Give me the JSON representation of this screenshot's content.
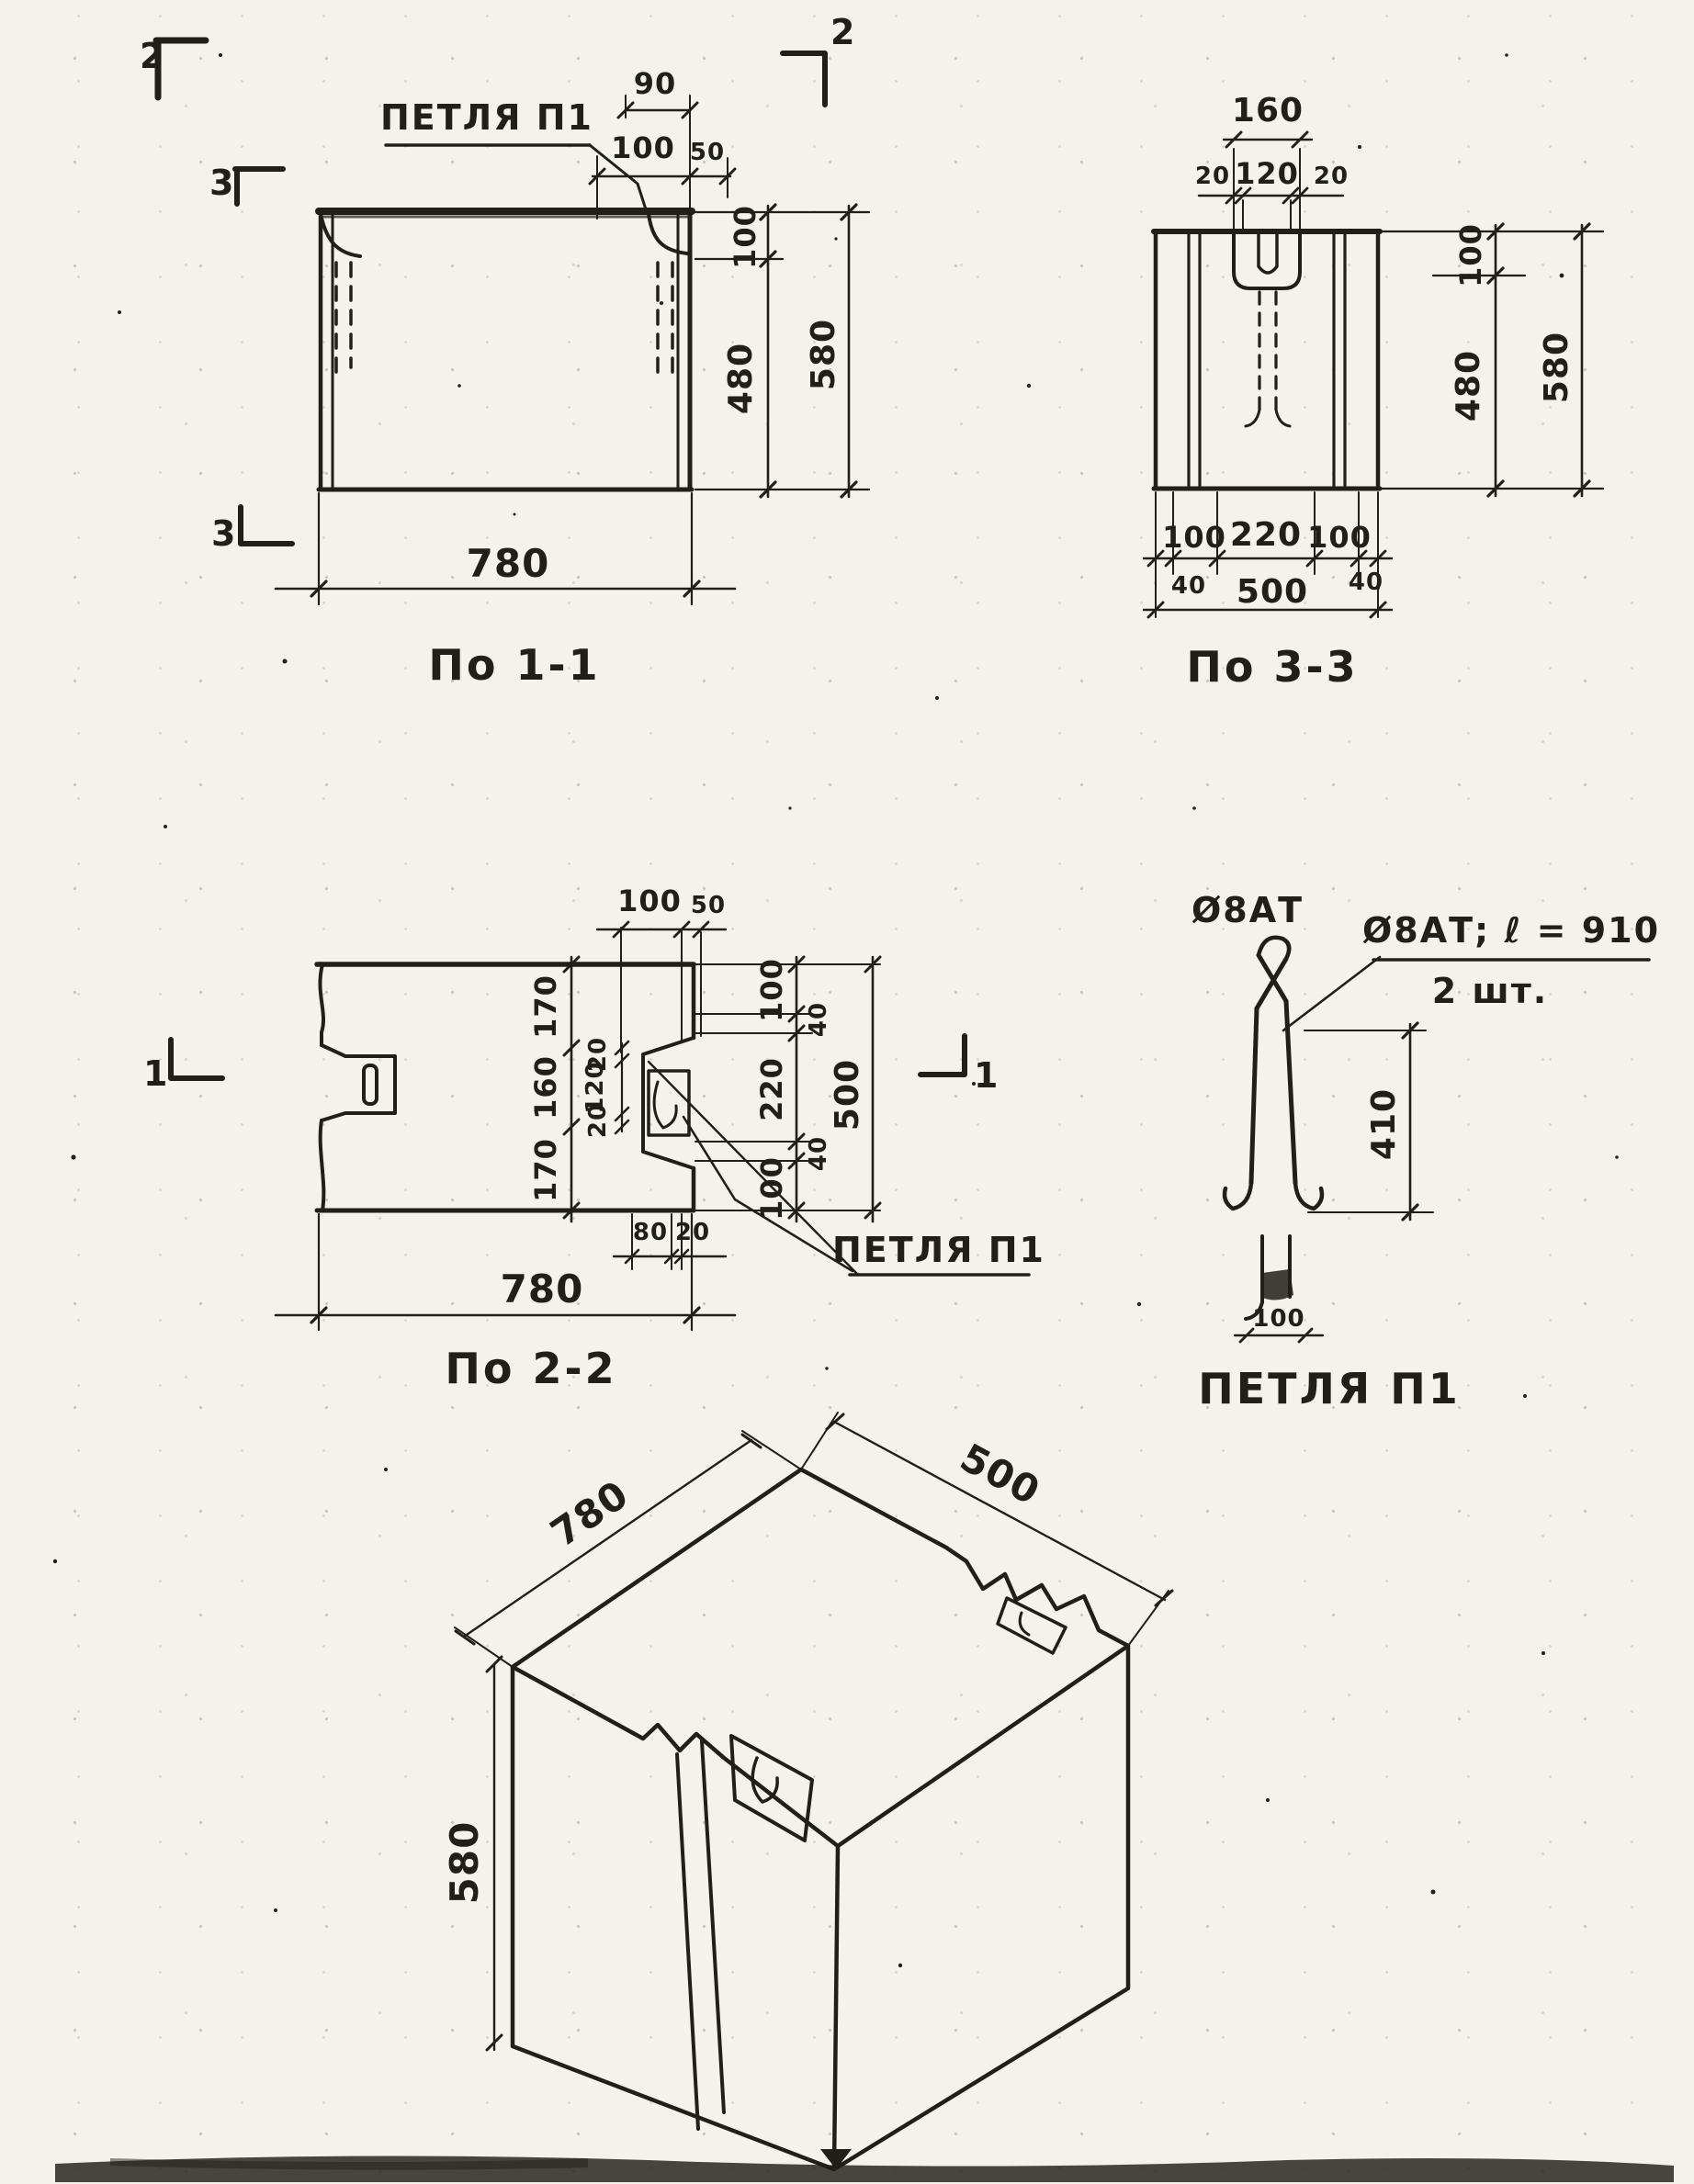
{
  "drawing": {
    "ink_color": "#211f1a",
    "paper_color": "#f4f2ea",
    "views": {
      "s11": {
        "caption": "По 1-1",
        "loop_label": "ПЕТЛЯ П1",
        "marks": {
          "top_left": "2",
          "left_upper": "3",
          "left_lower": "3",
          "top_right": "2"
        },
        "dims": {
          "top_90": "90",
          "top_100": "100",
          "top_50": "50",
          "right_100": "100",
          "right_480": "480",
          "right_580": "580",
          "bottom_780": "780"
        }
      },
      "s33": {
        "caption": "По 3-3",
        "dims": {
          "top_160": "160",
          "top_20a": "20",
          "top_120": "120",
          "top_20b": "20",
          "right_100": "100",
          "right_480": "480",
          "right_580": "580",
          "bot_100a": "100",
          "bot_220": "220",
          "bot_100b": "100",
          "bot_40a": "40",
          "bot_40b": "40",
          "bot_500": "500"
        }
      },
      "s22": {
        "caption": "По 2-2",
        "loop_label": "ПЕТЛЯ П1",
        "marks": {
          "left": "1",
          "right": "1"
        },
        "dims": {
          "top_100": "100",
          "top_50": "50",
          "mid_170a": "170",
          "mid_160": "160",
          "mid_170b": "170",
          "slot_20a": "20",
          "slot_120": "120",
          "slot_20b": "20",
          "right_100a": "100",
          "right_40a": "40",
          "right_220": "220",
          "right_40b": "40",
          "right_100b": "100",
          "right_500": "500",
          "bot_80": "80",
          "bot_20": "20",
          "bot_780": "780"
        }
      },
      "loop": {
        "caption": "ПЕТЛЯ П1",
        "bar_mark": "Ø8АТ",
        "note_line1": "Ø8АТ; ℓ = 910",
        "note_line2": "2 шт.",
        "dims": {
          "height_410": "410",
          "width_100": "100"
        }
      },
      "iso": {
        "dims": {
          "length_780": "780",
          "width_500": "500",
          "height_580": "580"
        }
      }
    }
  }
}
